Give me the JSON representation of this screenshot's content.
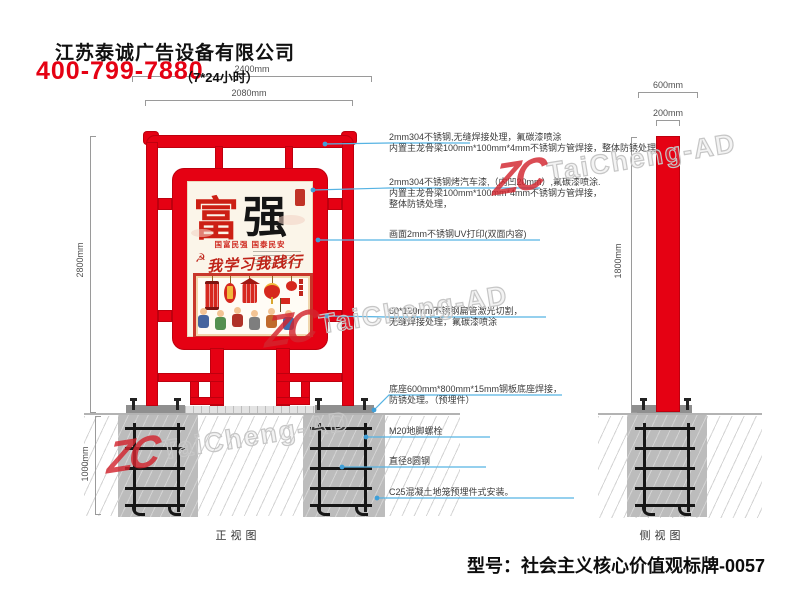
{
  "header": {
    "company": "江苏泰诚广告设备有限公司",
    "phone": "400-799-7880",
    "hours": "（7*24小时）"
  },
  "drawing": {
    "front_label": "正视图",
    "side_label": "侧视图",
    "dims": {
      "total_width": "2400mm",
      "frame_width": "2080mm",
      "height": "2800mm",
      "foundation_depth": "1000mm",
      "base_width": "600mm",
      "column_width": "200mm",
      "side_height": "1800mm"
    }
  },
  "poster": {
    "char1": "富",
    "char2": "强",
    "subtitle": "国富民强 国泰民安",
    "slogan": "我学习我践行",
    "emblem": "☭"
  },
  "annotations": [
    {
      "lines": [
        "2mm304不锈钢,无缝焊接处理，氟碳漆喷涂",
        "内置主龙骨梁100mm*100mm*4mm不锈钢方管焊接，整体防锈处理，"
      ]
    },
    {
      "lines": [
        "2mm304不锈钢烤汽车漆,（内凹20mm）,氟碳漆喷涂.",
        "内置主龙骨梁100mm*100mm*4mm不锈钢方管焊接，",
        "整体防锈处理，"
      ]
    },
    {
      "lines": [
        "画面2mm不锈钢UV打印(双面内容)"
      ]
    },
    {
      "lines": [
        "60*120mm不锈钢扁管激光切割，",
        "无缝焊接处理，氟碳漆喷涂"
      ]
    },
    {
      "lines": [
        "底座600mm*800mm*15mm钢板底座焊接，",
        "防锈处理。（预埋件）"
      ]
    },
    {
      "lines": [
        "M20地脚螺栓"
      ]
    },
    {
      "lines": [
        "直径8圆钢"
      ]
    },
    {
      "lines": [
        "C25混凝土地笼预埋件式安装。"
      ]
    }
  ],
  "footer": {
    "model": "型号：社会主义核心价值观标牌-0057"
  },
  "watermark": {
    "logo": "ZC",
    "brand": "TaiCheng-AD"
  },
  "colors": {
    "accent_red": "#e50113",
    "leader_blue": "#56b3e3",
    "dimension_gray": "#9a9a9a",
    "concrete_gray": "#bcbcbc"
  }
}
